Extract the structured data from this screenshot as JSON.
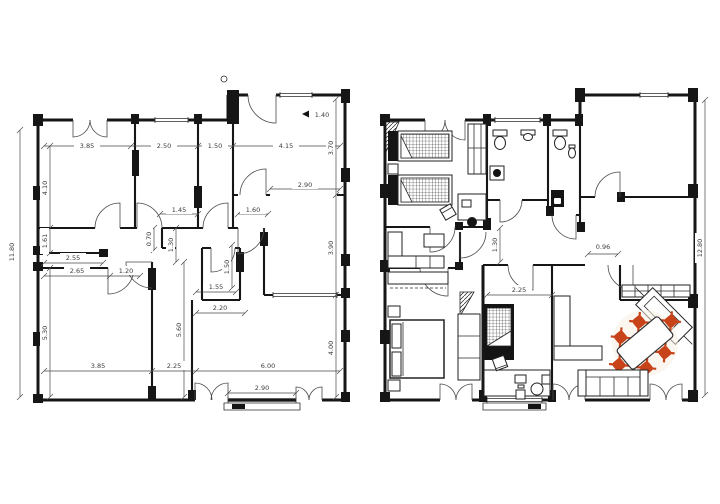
{
  "colors": {
    "paper": "#ffffff",
    "ink": "#161616",
    "dim_text": "#3d3d3d",
    "chair_accent": "#c8431a"
  },
  "left_plan": {
    "dims": {
      "overall_left": "11.80",
      "top_a": "3.85",
      "top_b": "2.50",
      "top_c": "1.50",
      "top_d": "4.15",
      "entry": "1.40",
      "v_room_tl": "4.10",
      "v_left_mid": "1.61",
      "v_left_bot": "5.30",
      "v_right_top": "3.70",
      "v_right_mid": "3.90",
      "v_right_bot": "4.00",
      "patio": "2.90",
      "hall_a": "1.45",
      "hall_b": "1.60",
      "v_hall_a": "0.70",
      "v_hall_b": "1.30",
      "closet_a": "2.55",
      "closet_b": "2.65",
      "closet_door": "1.20",
      "v_wc": "1.50",
      "wc_a": "1.55",
      "wc_b": "2.20",
      "v_mid_bot": "5.60",
      "bottom_a": "3.85",
      "bottom_b": "2.25",
      "bottom_c": "6.00",
      "bottom_window": "2.90"
    }
  },
  "right_plan": {
    "dims": {
      "hall": "1.30",
      "office": "2.25",
      "passage": "0.96",
      "overall_right": "12.80"
    }
  }
}
